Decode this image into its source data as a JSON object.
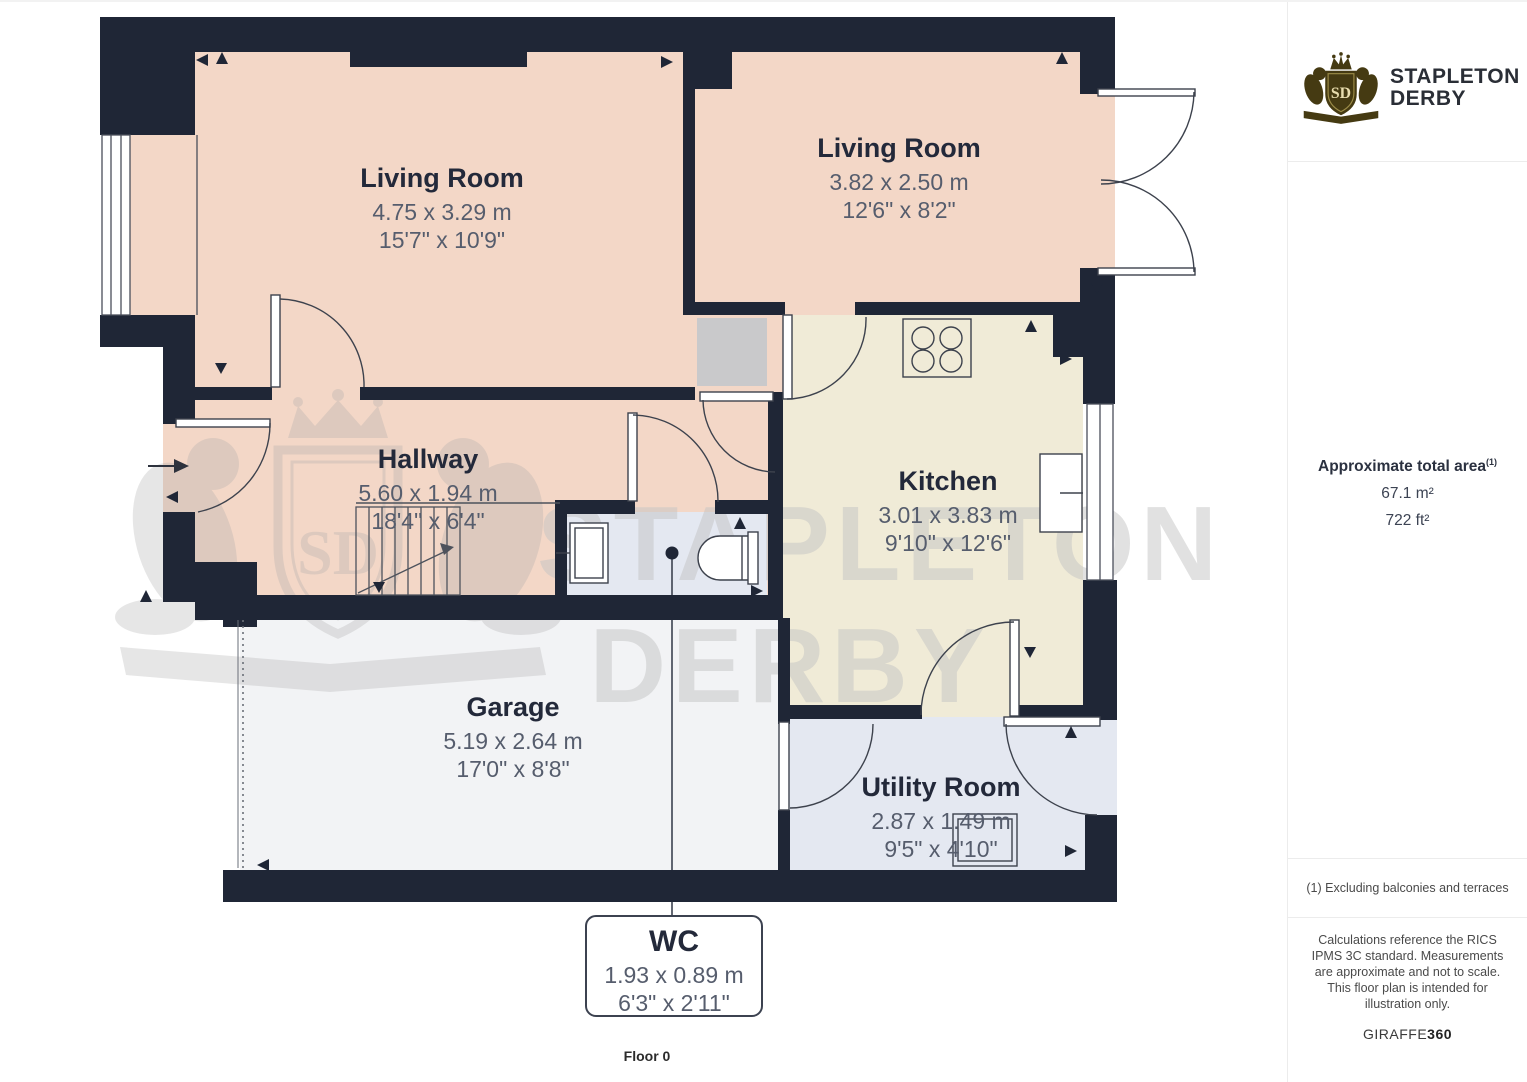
{
  "colors": {
    "wall": "#1f2636",
    "pink": "#f3d7c7",
    "cream": "#f0ebd7",
    "blue": "#e4e8f1",
    "garage": "#f2f3f5",
    "chimney": "#c9c9cb",
    "line": "#3d424d",
    "title": "#23293a",
    "dim": "#565d6d",
    "brand": "#453a12",
    "watermark": "#a8a8a8"
  },
  "floorplan": {
    "floor_label": "Floor 0",
    "rooms": [
      {
        "name": "Living Room",
        "metric": "4.75 x 3.29 m",
        "imperial": "15'7\" x 10'9\""
      },
      {
        "name": "Living Room",
        "metric": "3.82 x 2.50 m",
        "imperial": "12'6\" x 8'2\""
      },
      {
        "name": "Hallway",
        "metric": "5.60 x 1.94 m",
        "imperial": "18'4\" x 6'4\""
      },
      {
        "name": "Kitchen",
        "metric": "3.01 x 3.83 m",
        "imperial": "9'10\" x 12'6\""
      },
      {
        "name": "Garage",
        "metric": "5.19 x 2.64 m",
        "imperial": "17'0\" x 8'8\""
      },
      {
        "name": "Utility Room",
        "metric": "2.87 x 1.49 m",
        "imperial": "9'5\" x 4'10\""
      },
      {
        "name": "WC",
        "metric": "1.93 x 0.89 m",
        "imperial": "6'3\" x 2'11\""
      }
    ],
    "watermark": {
      "line1": "STAPLETON",
      "line2": "DERBY",
      "monogram": "SD"
    }
  },
  "sidebar": {
    "brand": {
      "name_line1": "STAPLETON",
      "name_line2": "DERBY",
      "monogram": "SD"
    },
    "area": {
      "title": "Approximate total area",
      "superscript": "(1)",
      "metric": "67.1 m²",
      "imperial": "722 ft²"
    },
    "footnote": "(1) Excluding balconies and terraces",
    "disclaimer": "Calculations reference the RICS IPMS 3C standard. Measurements are approximate and not to scale. This floor plan is intended for illustration only.",
    "credit_normal": "GIRAFFE",
    "credit_bold": "360"
  }
}
